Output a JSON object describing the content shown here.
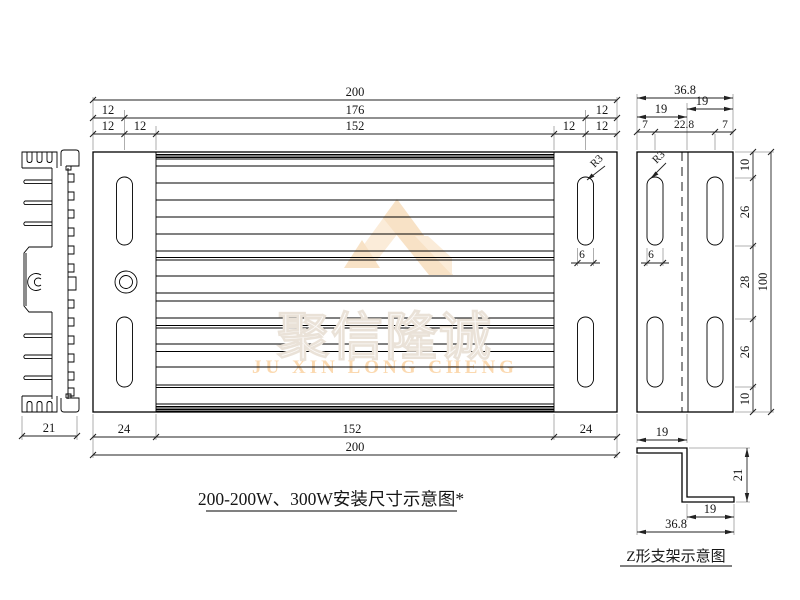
{
  "watermark": {
    "company_cn": "聚信隆诚",
    "company_en": "JU XIN LONG CHENG",
    "logo_color_light": "#fbecd9",
    "logo_color_dark": "#f8e2c6"
  },
  "titles": {
    "main": "200-200W、300W安装尺寸示意图*",
    "bracket": "Z形支架示意图"
  },
  "front_view": {
    "dim_width_total": "200",
    "dim_width_slots": "176",
    "dim_width_ribs": "152",
    "dim_offset": "12",
    "dim_end": "24",
    "dim_ribs_bottom": "152",
    "dim_total_bottom": "200",
    "slot_radius": "R3",
    "slot_width": "6"
  },
  "heatsink": {
    "dim_width": "21"
  },
  "side_view": {
    "dim_width_total": "36.8",
    "dim_flange_left": "19",
    "dim_flange_right": "19",
    "dim_edge_left": "7",
    "dim_center": "22.8",
    "dim_edge_right": "7",
    "dim_v_top": "10",
    "dim_v_upper": "26",
    "dim_v_mid": "28",
    "dim_v_lower": "26",
    "dim_v_bottom": "10",
    "dim_height_total": "100",
    "dim_bracket_width": "19",
    "slot_radius": "R3",
    "slot_width": "6"
  },
  "z_bracket": {
    "dim_top_flange": "19",
    "dim_height": "21",
    "dim_bottom_flange": "19",
    "dim_total_width": "36.8"
  }
}
